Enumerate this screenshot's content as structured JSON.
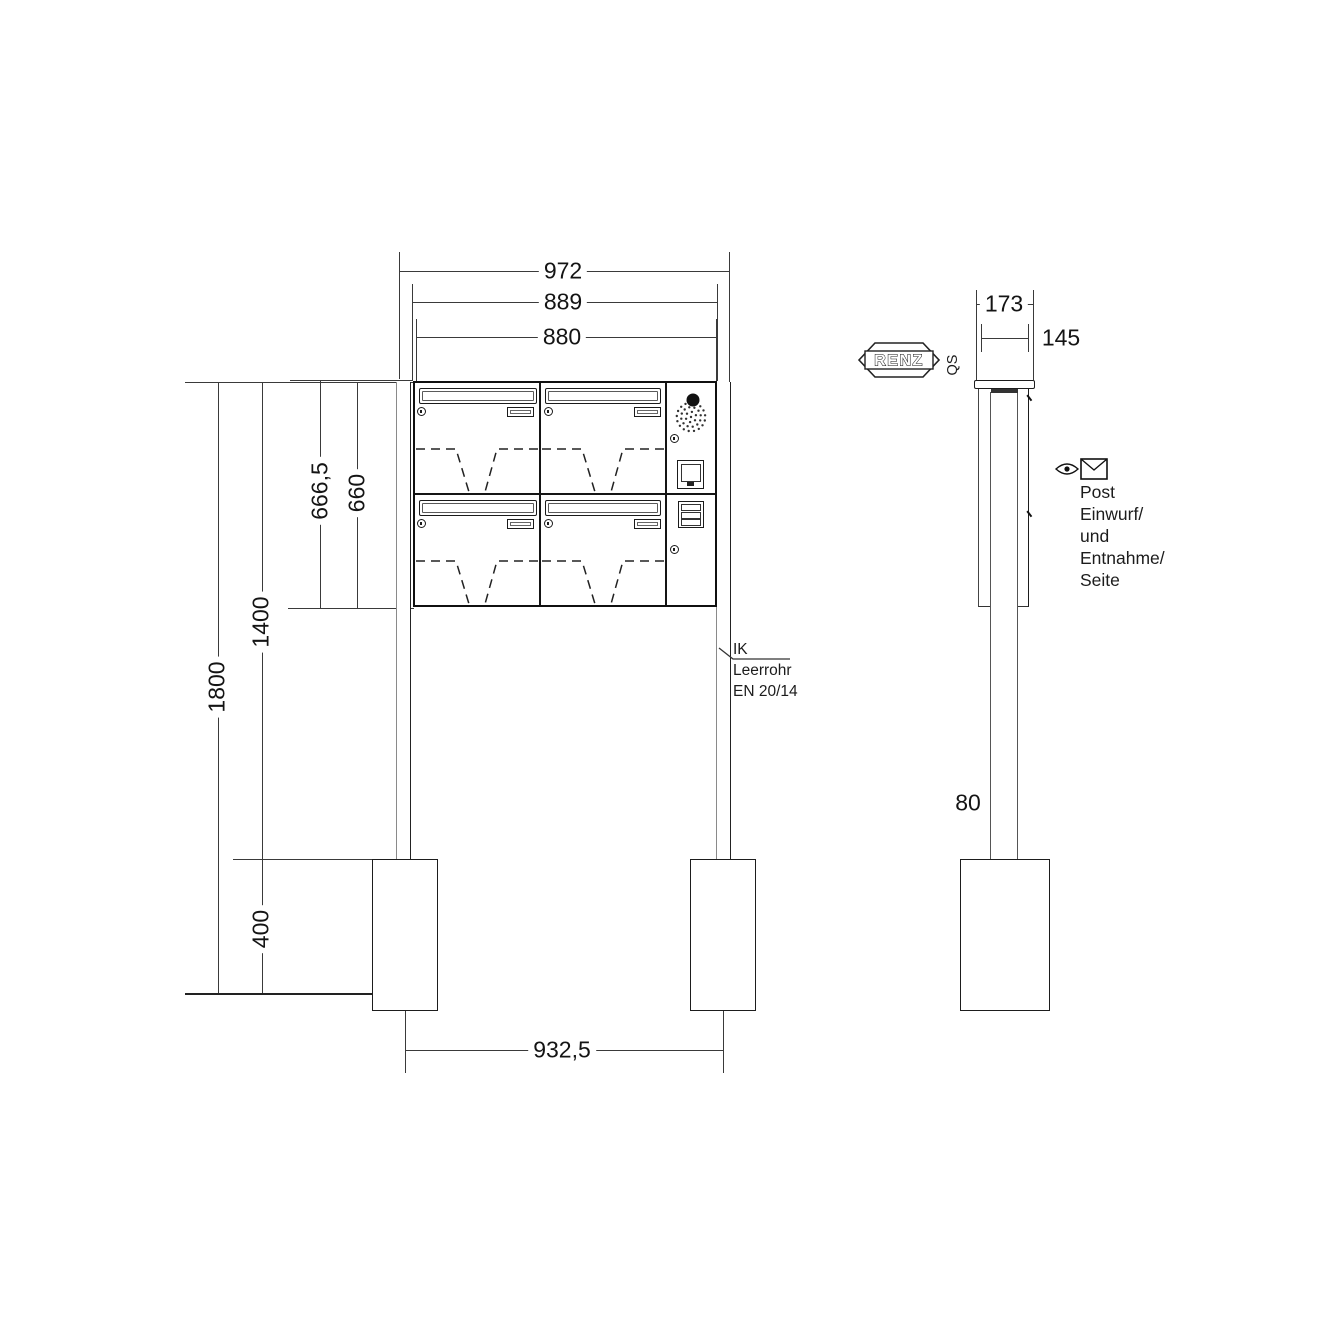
{
  "brand": {
    "logo": "RENZ",
    "qs": "QS"
  },
  "front": {
    "dim_cover_width": "972",
    "dim_cabinet_width": "889",
    "dim_boxes_width": "880",
    "dim_height_with_cover": "666,5",
    "dim_height_cabinet": "660",
    "dim_top_to_foundation": "1400",
    "dim_top_to_ground": "1800",
    "dim_foundation_height": "400",
    "dim_post_spacing": "932,5",
    "leader": {
      "l1": "IK",
      "l2": "Leerrohr",
      "l3": "EN 20/14"
    }
  },
  "side": {
    "dim_depth_overall": "173",
    "dim_depth_body": "145",
    "dim_post": "80",
    "note": [
      "Post",
      "Einwurf/",
      "und",
      "Entnahme/",
      "Seite"
    ]
  }
}
